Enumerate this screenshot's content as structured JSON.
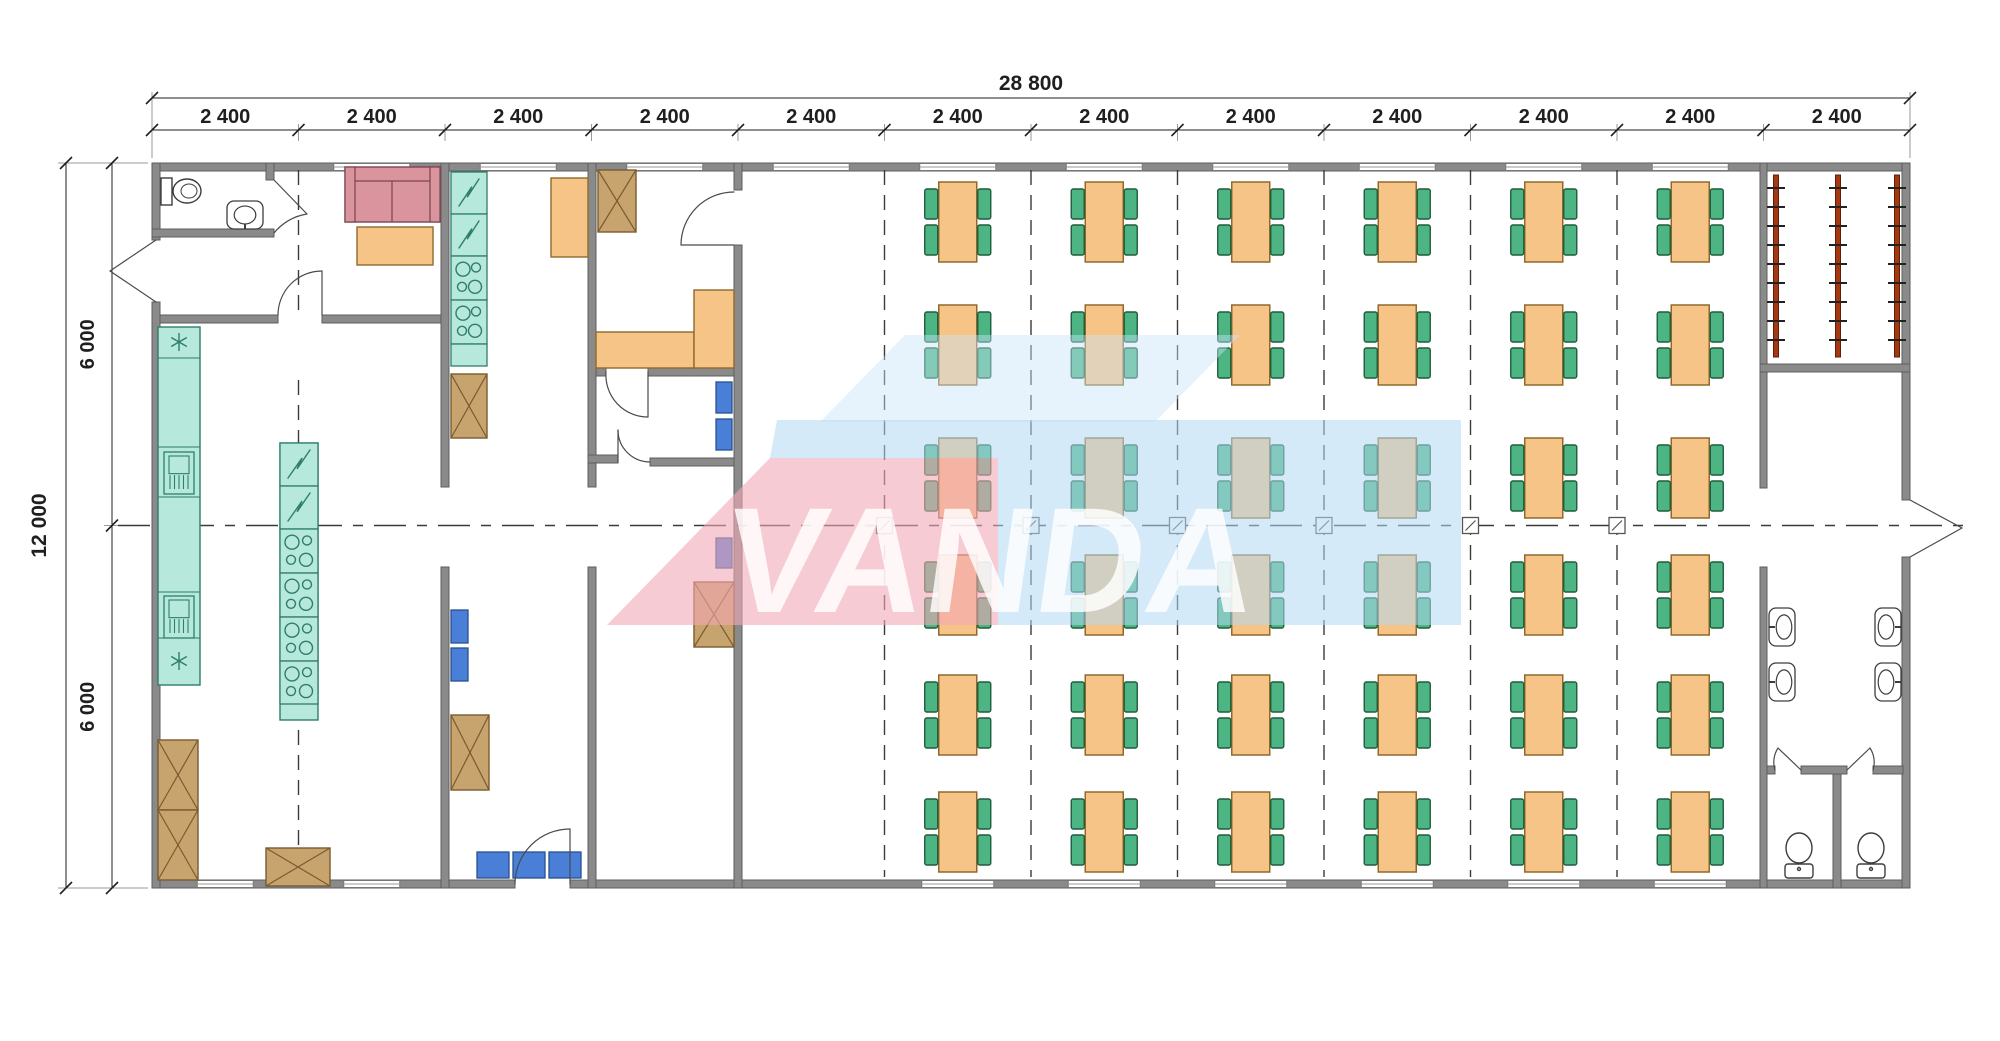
{
  "diagram": {
    "type": "floor-plan",
    "watermark": {
      "text": "VANDA"
    },
    "dimensions": {
      "top_total": "28 800",
      "top_segments": [
        "2 400",
        "2 400",
        "2 400",
        "2 400",
        "2 400",
        "2 400",
        "2 400",
        "2 400",
        "2 400",
        "2 400",
        "2 400",
        "2 400"
      ],
      "left_total": "12 000",
      "left_segments": [
        "6 000",
        "6 000"
      ]
    },
    "dining_area": {
      "table_columns": 6,
      "table_rows": 6,
      "table_count": 36,
      "chairs_per_table": 4
    },
    "fixtures": {
      "coat_racks": 3,
      "washroom_sinks": 4,
      "toilet_stalls": 2,
      "wc_toilets": 1,
      "wc_sinks": 1,
      "sofas": 1,
      "coffee_tables": 1,
      "storage_crates": 7,
      "blue_chairs": 8,
      "stove_units": 8,
      "fridge_units": 2
    },
    "colors": {
      "wall": "#8a8a8a",
      "wallEdge": "#5e5e5e",
      "teal": "#b6e8db",
      "tealLine": "#2f7d6c",
      "orange": "#f7c488",
      "orangeLine": "#8f6a2a",
      "green": "#4db583",
      "greenLine": "#1e5c3b",
      "blue": "#4a7fd8",
      "blueLine": "#27508f",
      "crate": "#c7a36d",
      "crateLine": "#7a5b30",
      "sofa": "#d9949e",
      "sofaLine": "#7c4450",
      "rack": "#a53a12",
      "dash": "#3a3a3a",
      "dim": "#1f1f1f",
      "door": "#4a4a4a",
      "fixture": "#3d3d3d",
      "wmPink": "rgba(242,168,182,0.60)",
      "wmBlue": "rgba(178,216,242,0.55)",
      "wmBlueTop": "rgba(200,228,248,0.45)",
      "wmText": "rgba(255,255,255,0.82)"
    }
  }
}
